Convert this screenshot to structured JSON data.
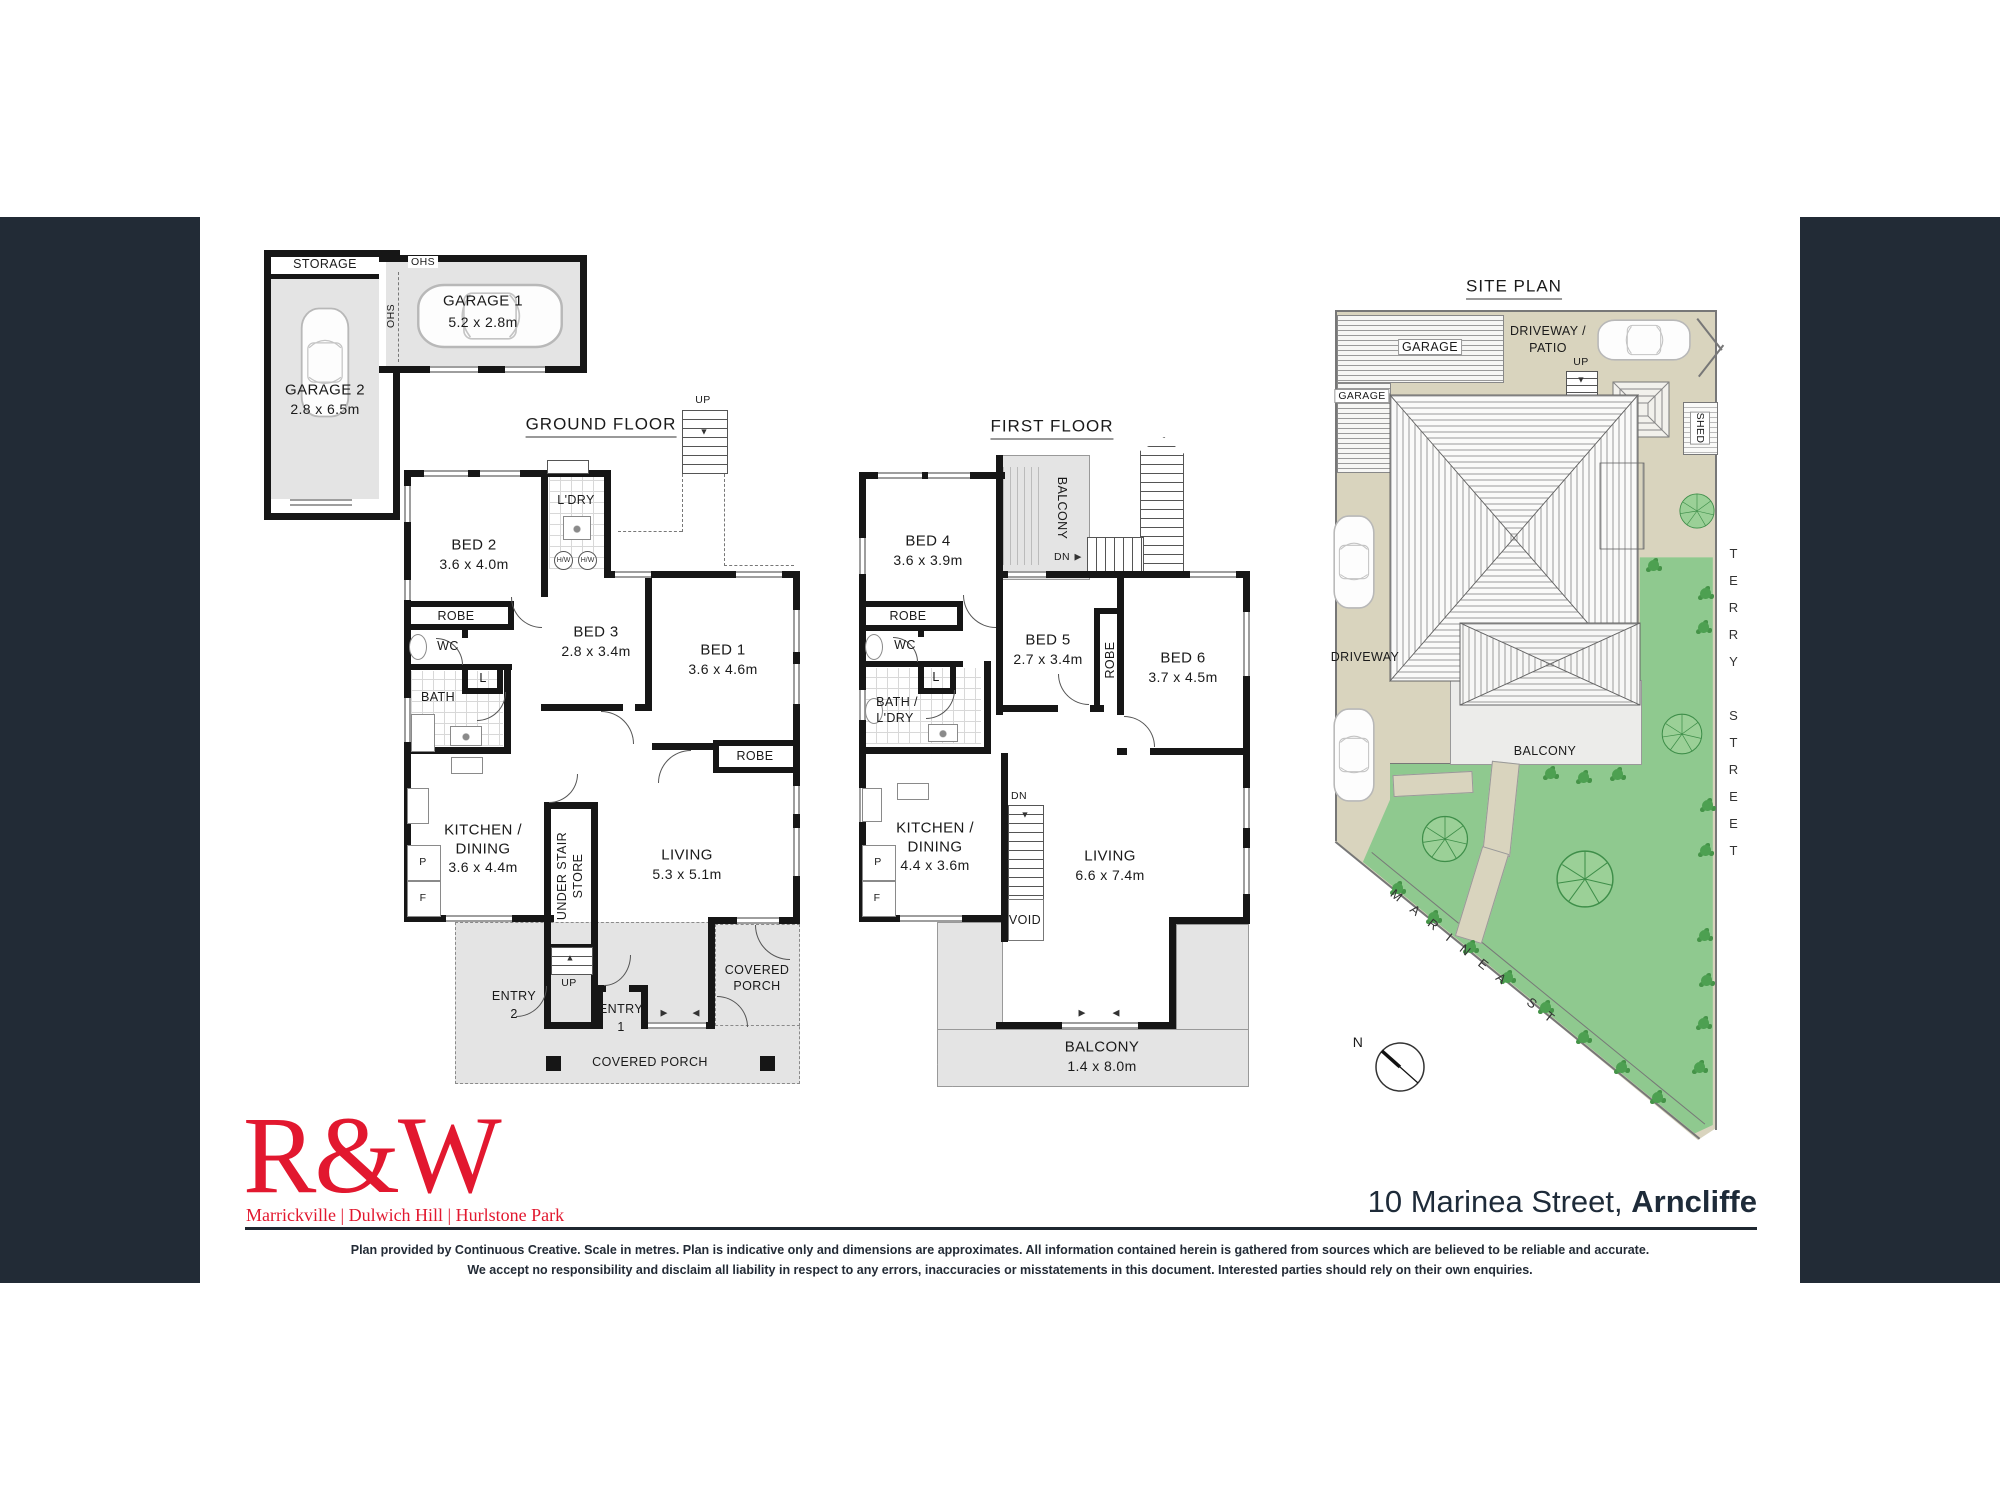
{
  "colors": {
    "brand_red": "#E2182F",
    "navy": "#222B36",
    "lawn_green": "#8FC98F",
    "driveway_beige": "#D9D4BE"
  },
  "icons": {
    "tri_up": "▲",
    "tri_down": "▼",
    "tri_right": "▶",
    "tri_left": "◀"
  },
  "footer": {
    "logo": "R&W",
    "offices": "Marrickville | Dulwich Hill | Hurlstone Park",
    "address_regular": "10 Marinea Street, ",
    "address_bold": "Arncliffe",
    "disclaimer1": "Plan provided by Continuous Creative. Scale in metres. Plan is indicative only and dimensions are approximates. All information contained herein is gathered from sources which are believed to be reliable and accurate.",
    "disclaimer2": "We accept no responsibility and disclaim all liability in respect to any errors, inaccuracies or misstatements in this document. Interested parties should rely on their own enquiries."
  },
  "garage_block": {
    "storage": "STORAGE",
    "garage2_name": "GARAGE 2",
    "garage2_dims": "2.8 x 6.5m",
    "garage1_name": "GARAGE 1",
    "garage1_dims": "5.2 x 2.8m",
    "ohs_top": "OHS",
    "ohs_side": "OHS"
  },
  "ground_floor": {
    "title": "GROUND FLOOR",
    "up_top": "UP",
    "up_stair": "UP",
    "bed2_name": "BED 2",
    "bed2_dims": "3.6 x 4.0m",
    "ldry": "L'DRY",
    "hw1": "H/W",
    "hw2": "H/W",
    "bed3_name": "BED 3",
    "bed3_dims": "2.8 x 3.4m",
    "bed1_name": "BED 1",
    "bed1_dims": "3.6 x 4.6m",
    "robe_bed2": "ROBE",
    "wc": "WC",
    "bath": "BATH",
    "linen": "L",
    "robe_bed1": "ROBE",
    "kitchen_name1": "KITCHEN /",
    "kitchen_name2": "DINING",
    "kitchen_dims": "3.6 x 4.4m",
    "pantry": "P",
    "fridge": "F",
    "under_stair1": "UNDER STAIR",
    "under_stair2": "STORE",
    "living_name": "LIVING",
    "living_dims": "5.3 x 5.1m",
    "entry2_l1": "ENTRY",
    "entry2_l2": "2",
    "entry1_l1": "ENTRY",
    "entry1_l2": "1",
    "porch_r1": "COVERED",
    "porch_r2": "PORCH",
    "porch_b": "COVERED PORCH"
  },
  "first_floor": {
    "title": "FIRST FLOOR",
    "balcony_top": "BALCONY",
    "dn_top": "DN",
    "bed4_name": "BED 4",
    "bed4_dims": "3.6 x 3.9m",
    "robe_bed4": "ROBE",
    "wc": "WC",
    "linen": "L",
    "bath1": "BATH /",
    "bath2": "L'DRY",
    "bed5_name": "BED 5",
    "bed5_dims": "2.7 x 3.4m",
    "robe_mid": "ROBE",
    "bed6_name": "BED 6",
    "bed6_dims": "3.7 x 4.5m",
    "kitchen_name1": "KITCHEN /",
    "kitchen_name2": "DINING",
    "kitchen_dims": "4.4 x 3.6m",
    "pantry": "P",
    "fridge": "F",
    "dn_stair": "DN",
    "void": "VOID",
    "living_name": "LIVING",
    "living_dims": "6.6 x 7.4m",
    "balcony_name": "BALCONY",
    "balcony_dims": "1.4 x 8.0m"
  },
  "site_plan": {
    "title": "SITE PLAN",
    "garage_top": "GARAGE",
    "garage_left": "GARAGE",
    "driveway_patio1": "DRIVEWAY /",
    "driveway_patio2": "PATIO",
    "up": "UP",
    "shed": "SHED",
    "driveway": "DRIVEWAY",
    "balcony": "BALCONY",
    "marinea": "MARINEA ST",
    "terry": "TERRY STREET",
    "north": "N"
  }
}
